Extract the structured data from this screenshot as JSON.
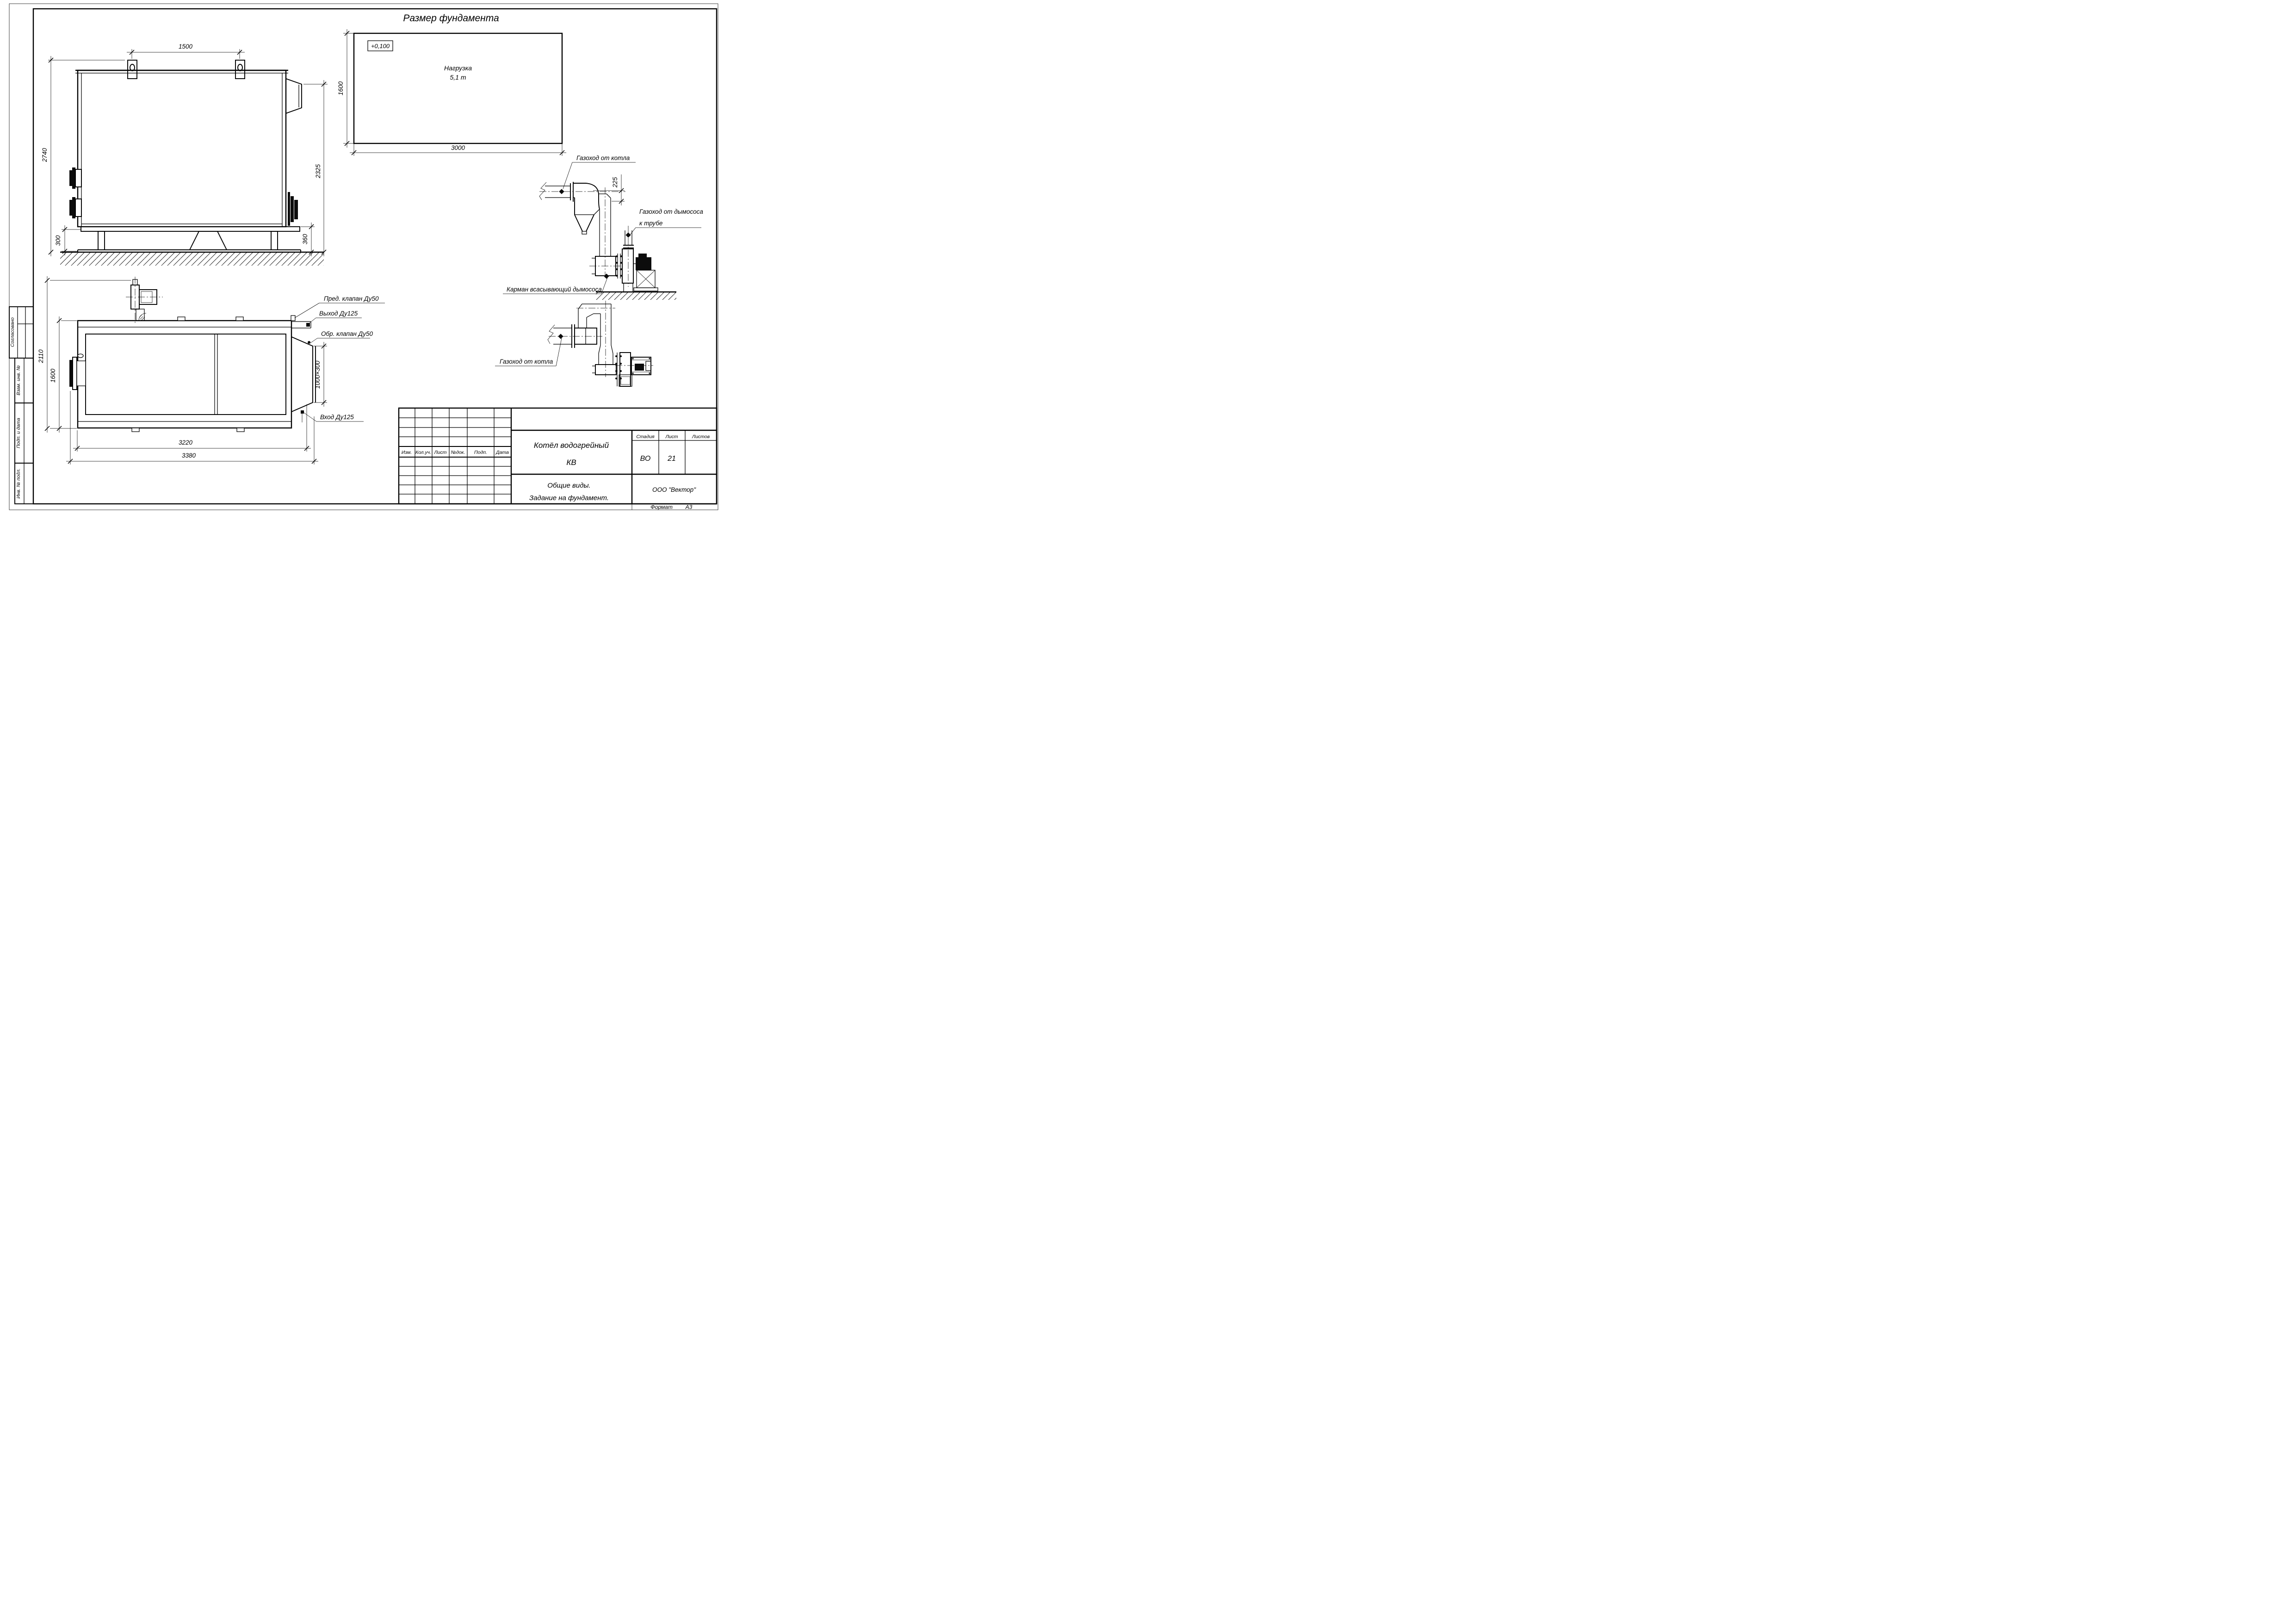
{
  "sheet": {
    "format_label": "Формат",
    "format_value": "А3"
  },
  "foundation": {
    "title": "Размер фундамента",
    "elevation": "+0,100",
    "load_line1": "Нагрузка",
    "load_line2": "5,1 т",
    "dim_width": "3000",
    "dim_depth": "1600"
  },
  "side_view": {
    "dim_lug_spacing": "1500",
    "dim_height": "2740",
    "dim_flue": "2325",
    "dim_frame": "300",
    "dim_base": "360"
  },
  "top_view": {
    "dim_overall_width": "2110",
    "dim_body_width": "1600",
    "dim_body_length": "3220",
    "dim_overall_length": "3380",
    "dim_flue_opening": "1000×300",
    "label_safety_valve": "Пред. клапан Ду50",
    "label_outlet": "Выход Ду125",
    "label_check_valve": "Обр. клапан Ду50",
    "label_inlet": "Вход Ду125"
  },
  "flue_side": {
    "label_boiler_duct": "Газоход от котла",
    "dim_offset": "225",
    "label_fan_duct_1": "Газоход от дымососа",
    "label_fan_duct_2": "к трубе",
    "label_pocket": "Карман всасывающий дымососа"
  },
  "flue_plan": {
    "label_boiler_duct": "Газоход от котла"
  },
  "title_block": {
    "rev_cols": [
      "Изм.",
      "Кол.уч.",
      "Лист",
      "№док.",
      "Подп.",
      "Дата"
    ],
    "doc_name_1": "Котёл водогрейный",
    "doc_name_2": "КВ",
    "stage_label": "Стадия",
    "sheet_label": "Лист",
    "sheets_label": "Листов",
    "stage_value": "ВО",
    "sheet_value": "21",
    "view_title_1": "Общие виды.",
    "view_title_2": "Задание на фундамент.",
    "company": "ООО \"Вектор\""
  },
  "sidebar": {
    "agreed": "Согласовано",
    "replace_inv": "Взам. инв. №",
    "sign_date": "Подп. и дата",
    "inv_orig": "Инв. № подл."
  }
}
